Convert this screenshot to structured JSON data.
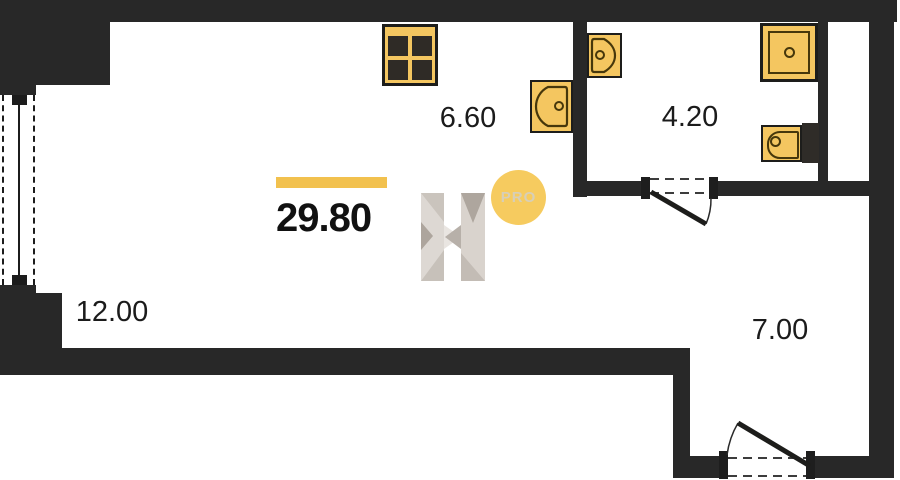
{
  "plan": {
    "total_area_label": "29.80",
    "rooms": [
      {
        "name": "kitchen-area",
        "area": "6.60"
      },
      {
        "name": "bathroom-area",
        "area": "4.20"
      },
      {
        "name": "living-area",
        "area": "12.00"
      },
      {
        "name": "hall-area",
        "area": "7.00"
      }
    ],
    "watermark": {
      "badge": "PRO"
    },
    "fixtures": [
      "stove",
      "kitchen-sink",
      "bathroom-sink",
      "shower",
      "toilet"
    ],
    "colors": {
      "wall": "#282828",
      "accent_bar": "#F2C14E",
      "fixture_fill": "#F4C660",
      "fixture_outline": "#46370B",
      "badge_fill": "#F6CB5F",
      "badge_text": "#D7CFB8",
      "label_text": "#1B1B1B"
    }
  }
}
